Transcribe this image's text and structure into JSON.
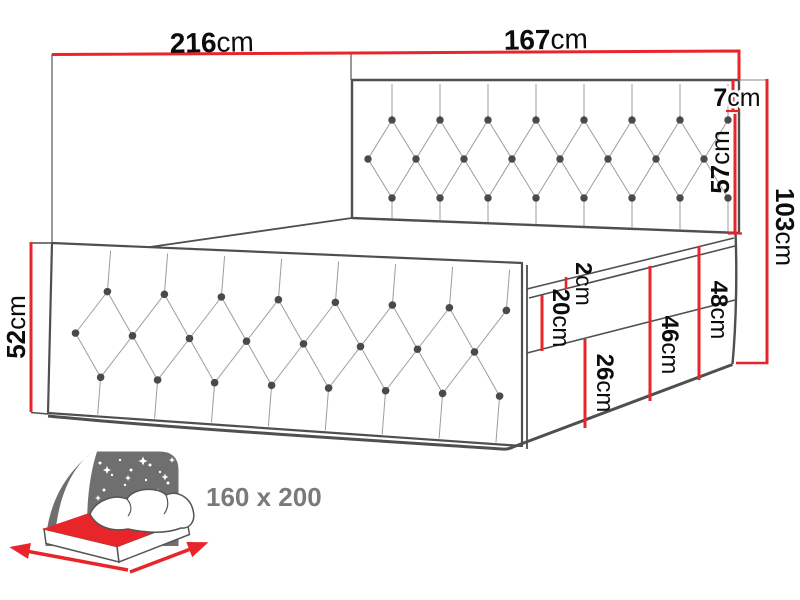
{
  "diagram": {
    "dimensions": {
      "total_width": {
        "value": "216",
        "unit": "cm"
      },
      "mattress_width": {
        "value": "167",
        "unit": "cm"
      },
      "headboard_frame": {
        "value": "7",
        "unit": "cm"
      },
      "headboard_panel": {
        "value": "57",
        "unit": "cm"
      },
      "total_height": {
        "value": "103",
        "unit": "cm"
      },
      "footboard_height": {
        "value": "52",
        "unit": "cm"
      },
      "topper": {
        "value": "2",
        "unit": "cm"
      },
      "mattress_thickness": {
        "value": "20",
        "unit": "cm"
      },
      "base_height": {
        "value": "26",
        "unit": "cm"
      },
      "mattress_plus_base": {
        "value": "46",
        "unit": "cm"
      },
      "side_height": {
        "value": "48",
        "unit": "cm"
      }
    },
    "size_badge": {
      "label": "160 x 200"
    },
    "colors": {
      "dimension_red": "#e8252a",
      "outline_gray": "#4f4f4f",
      "tufting_gray": "#9d9d9d",
      "icon_gray": "#6f6f6f",
      "badge_text_gray": "#7a7a7a"
    }
  }
}
